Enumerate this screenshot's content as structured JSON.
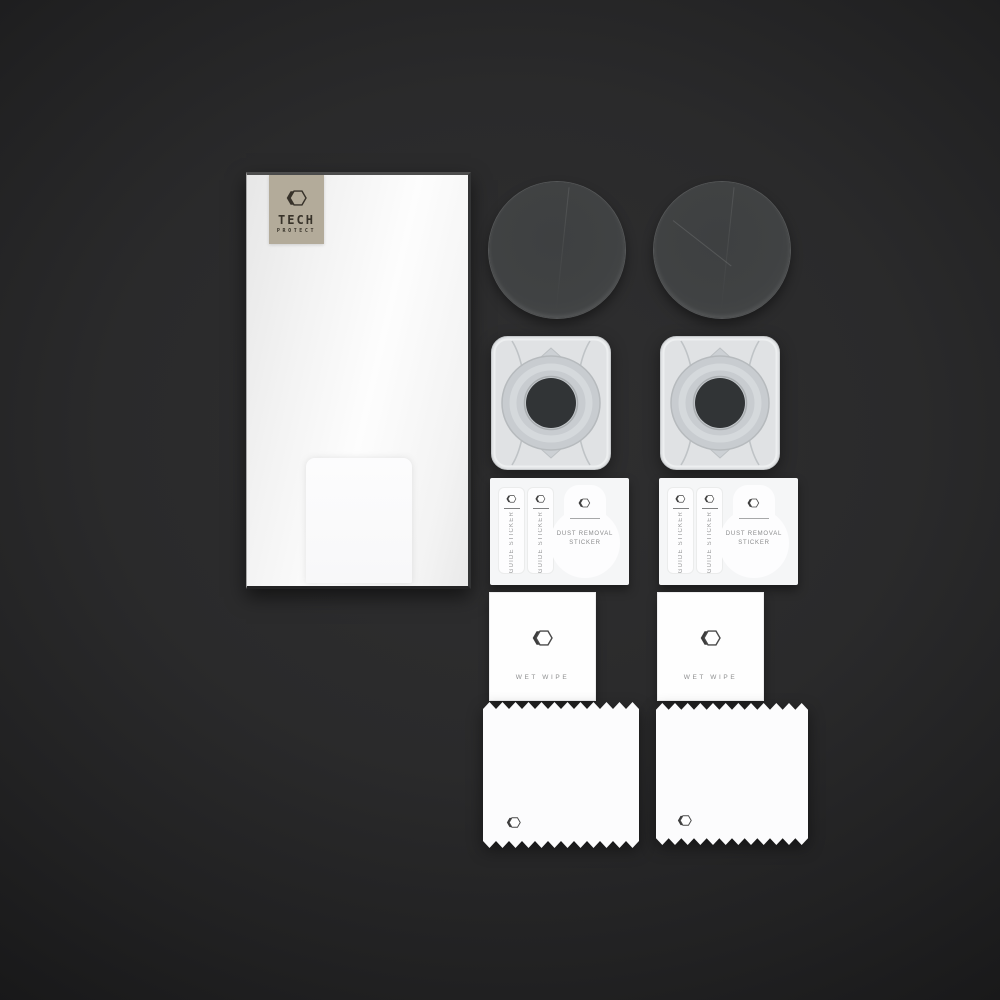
{
  "scene": {
    "description": "product kit photo on dark background",
    "background_color": "#2a2a2b"
  },
  "brand": {
    "line1": "TECH",
    "line2": "PROTECT",
    "label_color": "#b3ab9a",
    "logo_icon": "hexagon-logo"
  },
  "kit": {
    "quantities": {
      "glass_protectors": 2,
      "applicator_frames": 2,
      "sticker_sheets": 2,
      "wet_wipes": 2,
      "cloths": 2
    },
    "sticker_sheet": {
      "guide_sticker_label": "GUIDE STICKER",
      "dust_removal_line1": "DUST REMOVAL",
      "dust_removal_line2": "STICKER"
    },
    "wet_wipe": {
      "label": "WET WIPE"
    }
  }
}
